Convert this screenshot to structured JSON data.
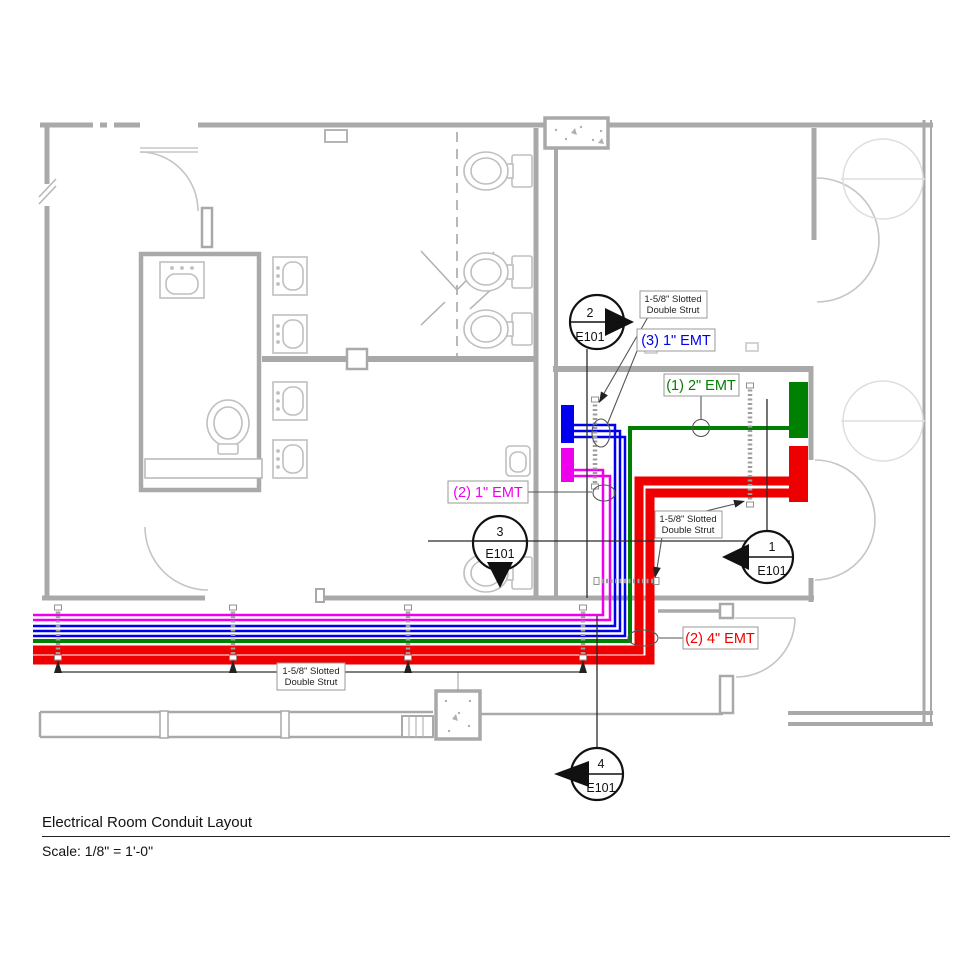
{
  "drawing": {
    "title": "Electrical Room Conduit Layout",
    "scale": "Scale: 1/8\" = 1'-0\"",
    "sheet": "E101"
  },
  "callouts": {
    "blue": {
      "text": "(3) 1\" EMT",
      "color": "#0000ee"
    },
    "green": {
      "text": "(1) 2\" EMT",
      "color": "#008000"
    },
    "magenta": {
      "text": "(2) 1\" EMT",
      "color": "#ee00ee"
    },
    "red": {
      "text": "(2) 4\" EMT",
      "color": "#ee0000"
    }
  },
  "strut_label": {
    "line1": "1-5/8\" Slotted",
    "line2": "Double Strut"
  },
  "markers": [
    {
      "num": "2",
      "sheet": "E101"
    },
    {
      "num": "3",
      "sheet": "E101"
    },
    {
      "num": "1",
      "sheet": "E101"
    },
    {
      "num": "4",
      "sheet": "E101"
    }
  ],
  "colors": {
    "wall_gray": "#a9a9a9",
    "fixture_gray": "#bfbfbf",
    "strut_gray": "#9e9e9e",
    "annotation_black": "#222222"
  }
}
